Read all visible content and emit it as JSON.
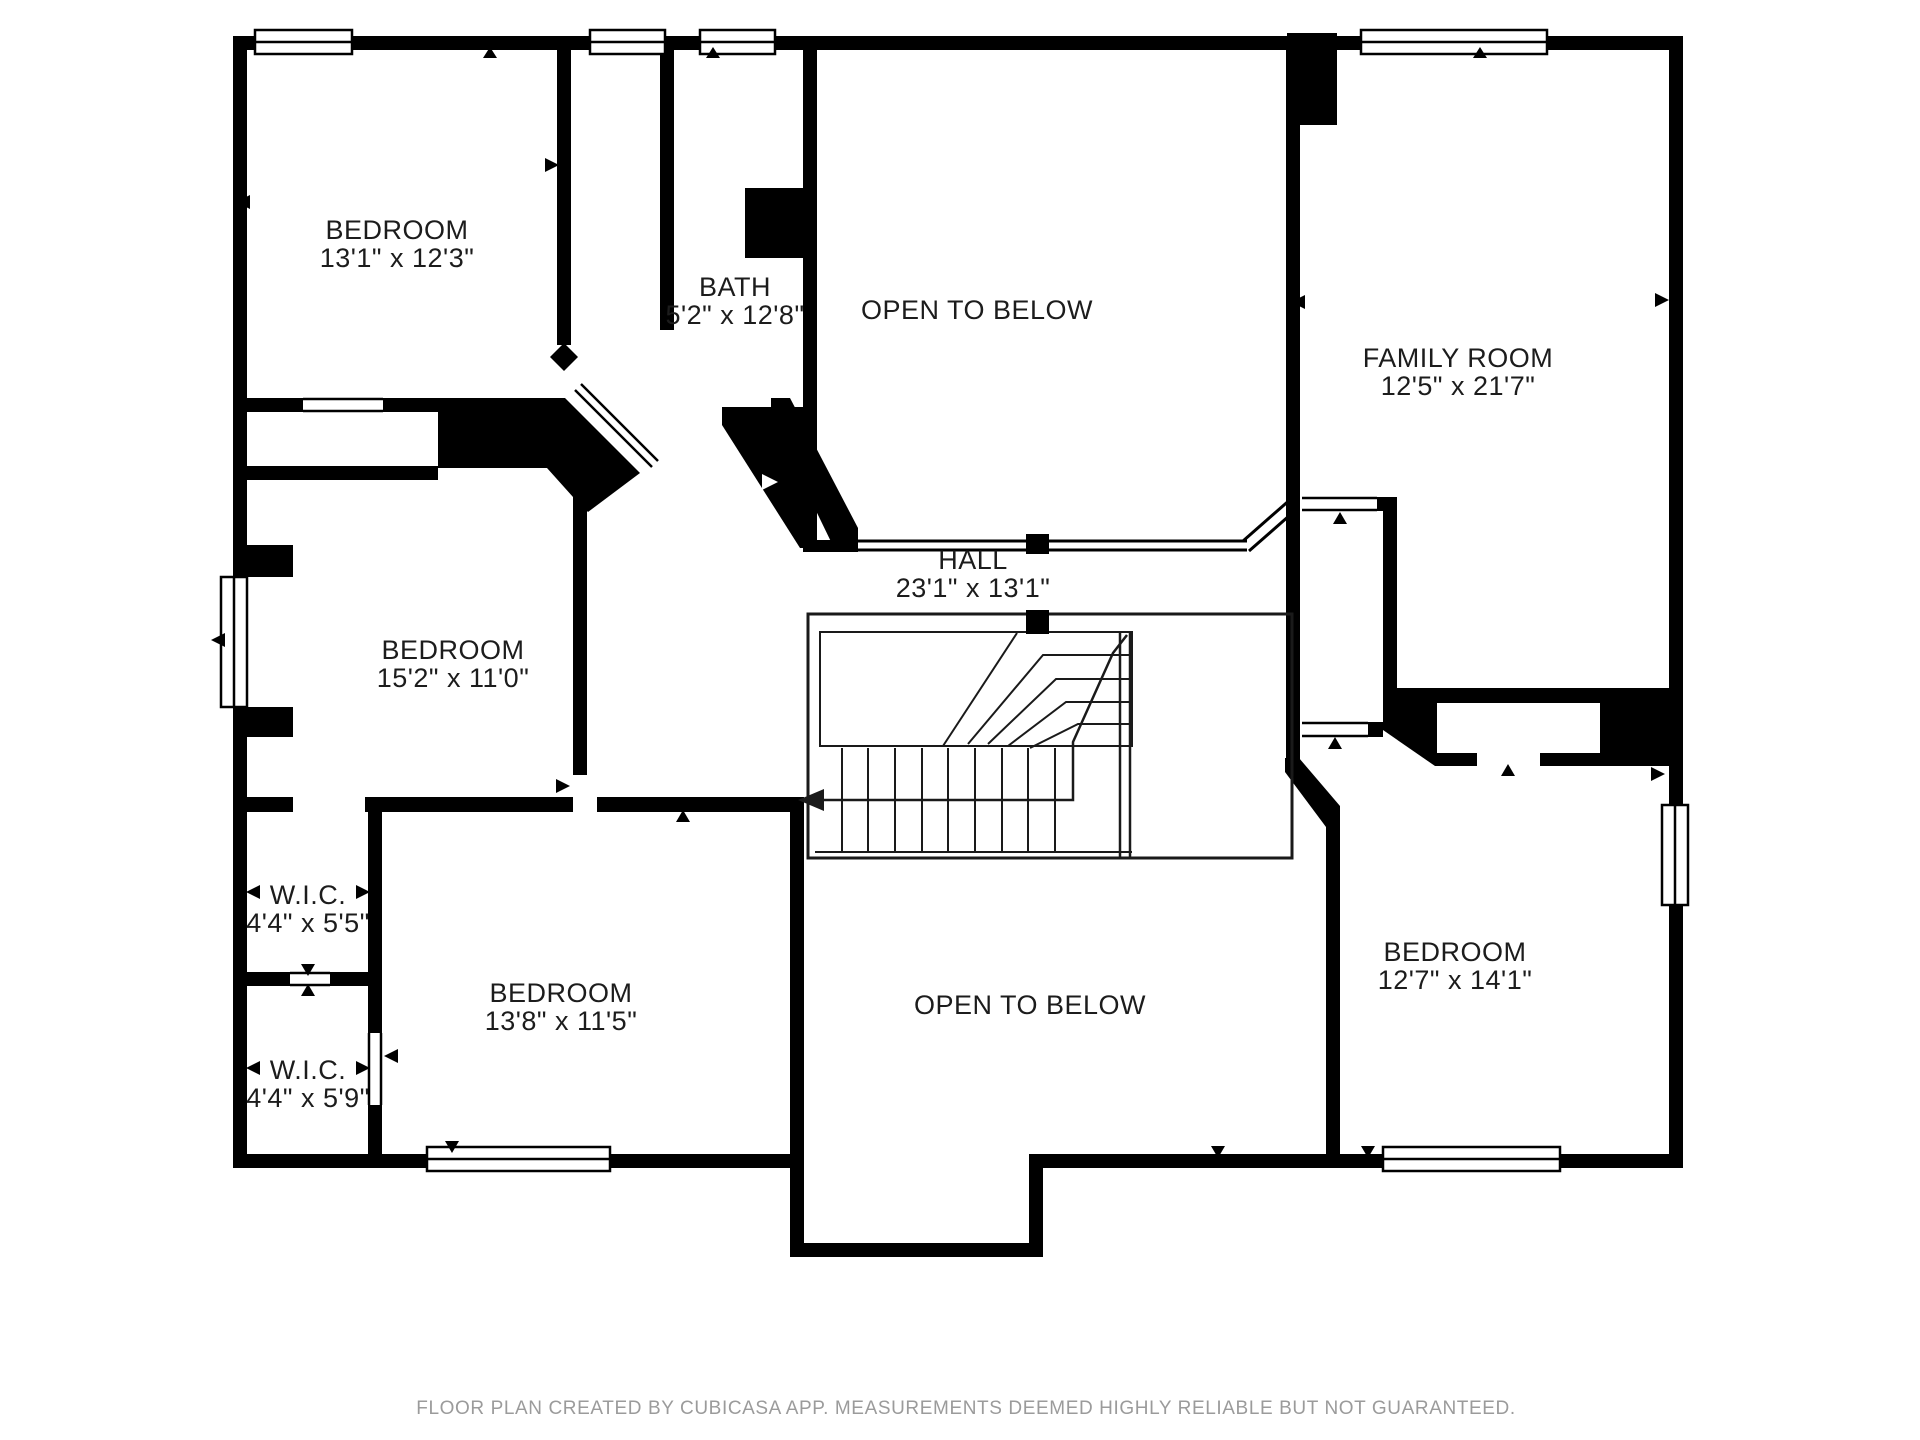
{
  "page": {
    "background_color": "#ffffff",
    "wall_color": "#000000",
    "label_color": "#1c1c1c",
    "footer_color": "#9b9b9b"
  },
  "floor_plan": {
    "rooms": [
      {
        "name": "BEDROOM",
        "dimensions": "13'1\" x 12'3\""
      },
      {
        "name": "BATH",
        "dimensions": "5'2\" x 12'8\""
      },
      {
        "name": "OPEN TO BELOW"
      },
      {
        "name": "FAMILY ROOM",
        "dimensions": "12'5\" x 21'7\""
      },
      {
        "name": "BEDROOM",
        "dimensions": "15'2\" x 11'0\""
      },
      {
        "name": "HALL",
        "dimensions": "23'1\" x 13'1\""
      },
      {
        "name": "W.I.C.",
        "dimensions": "4'4\" x 5'5\""
      },
      {
        "name": "W.I.C.",
        "dimensions": "4'4\" x 5'9\""
      },
      {
        "name": "BEDROOM",
        "dimensions": "13'8\" x 11'5\""
      },
      {
        "name": "OPEN TO BELOW"
      },
      {
        "name": "BEDROOM",
        "dimensions": "12'7\" x 14'1\""
      }
    ],
    "footer": "FLOOR PLAN CREATED BY CUBICASA APP. MEASUREMENTS DEEMED HIGHLY RELIABLE BUT NOT GUARANTEED."
  }
}
